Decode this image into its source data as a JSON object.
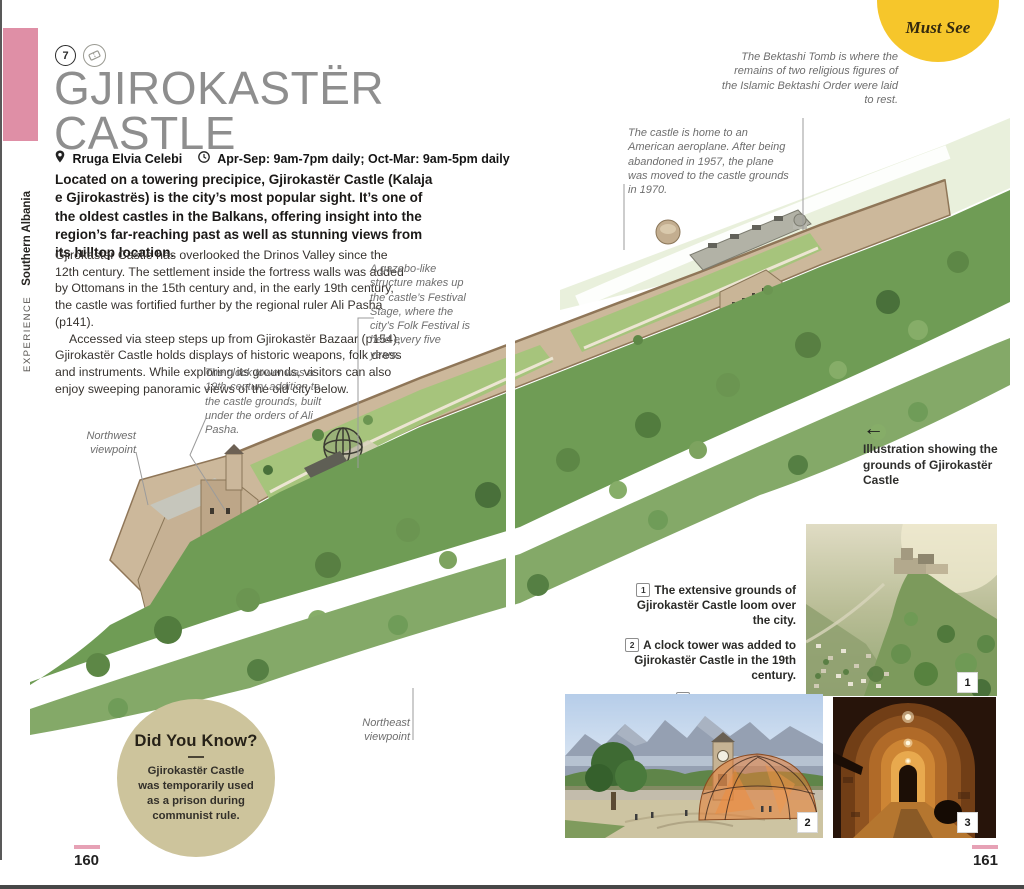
{
  "sidebar": {
    "section": "EXPERIENCE",
    "region": "Southern Albania"
  },
  "must_see": "Must See",
  "header": {
    "number": "7",
    "title_line1": "GJIROKASTËR",
    "title_line2": "CASTLE",
    "address": "Rruga Elvia Celebi",
    "hours": "Apr-Sep: 9am-7pm daily; Oct-Mar: 9am-5pm daily"
  },
  "intro": "Located on a towering precipice, Gjirokastër Castle (Kalaja e Gjirokastrës) is the city’s most popular sight. It’s one of the oldest castles in the Balkans, offering insight into the region’s far-reaching past as well as stunning views from its hilltop location.",
  "body": {
    "para1": "Gjirokastër Castle has overlooked the Drinos Valley since the 12th century. The settlement inside the fortress walls was added by Ottomans in the 15th century and, in the early 19th century, the castle was fortified further by the regional ruler Ali Pasha (p141).",
    "para2": "Accessed via steep steps up from Gjirokastër Bazaar (p154), Gjirokastër Castle holds displays of historic weapons, folk dress and instruments. While exploring its grounds, visitors can also enjoy sweeping panoramic views of the old city below."
  },
  "annotations": {
    "bektashi": "The Bektashi Tomb is where the remains of two religious figures of the Islamic Bektashi Order were laid to rest.",
    "aeroplane": "The castle is home to an American aeroplane. After being abandoned in 1957, the plane was moved to the castle grounds in 1970.",
    "gazebo": "A gazebo-like structure makes up the castle’s Festival Stage, where the city’s Folk Festival is held every five years.",
    "clock_tower": "The clock tower was a 19th-century addition to the castle grounds, built under the orders of Ali Pasha.",
    "northwest_viewpoint": "Northwest viewpoint",
    "northeast_viewpoint": "Northeast viewpoint",
    "illustration_caption": "Illustration showing the grounds of Gjirokastër Castle"
  },
  "captions": [
    {
      "num": "1",
      "text": "The extensive grounds of Gjirokastër Castle loom over the city."
    },
    {
      "num": "2",
      "text": "A clock tower was added to Gjirokastër Castle in the 19th century."
    },
    {
      "num": "3",
      "text": "Tunnels and stone corridors can be found inside Gjirokastër Castle."
    }
  ],
  "did_you_know": {
    "title": "Did You Know?",
    "text": "Gjirokastër Castle was temporarily used as a prison during communist rule."
  },
  "photos": [
    {
      "badge": "1"
    },
    {
      "badge": "2"
    },
    {
      "badge": "3"
    }
  ],
  "page_numbers": {
    "left": "160",
    "right": "161"
  },
  "icons": {
    "arrow_left": "←"
  },
  "colors": {
    "sidebar_pink": "#df8fa6",
    "must_see_yellow": "#f6c62b",
    "did_you_know_bg": "#cdc49c",
    "page_marker_pink": "#e6a1b5"
  }
}
